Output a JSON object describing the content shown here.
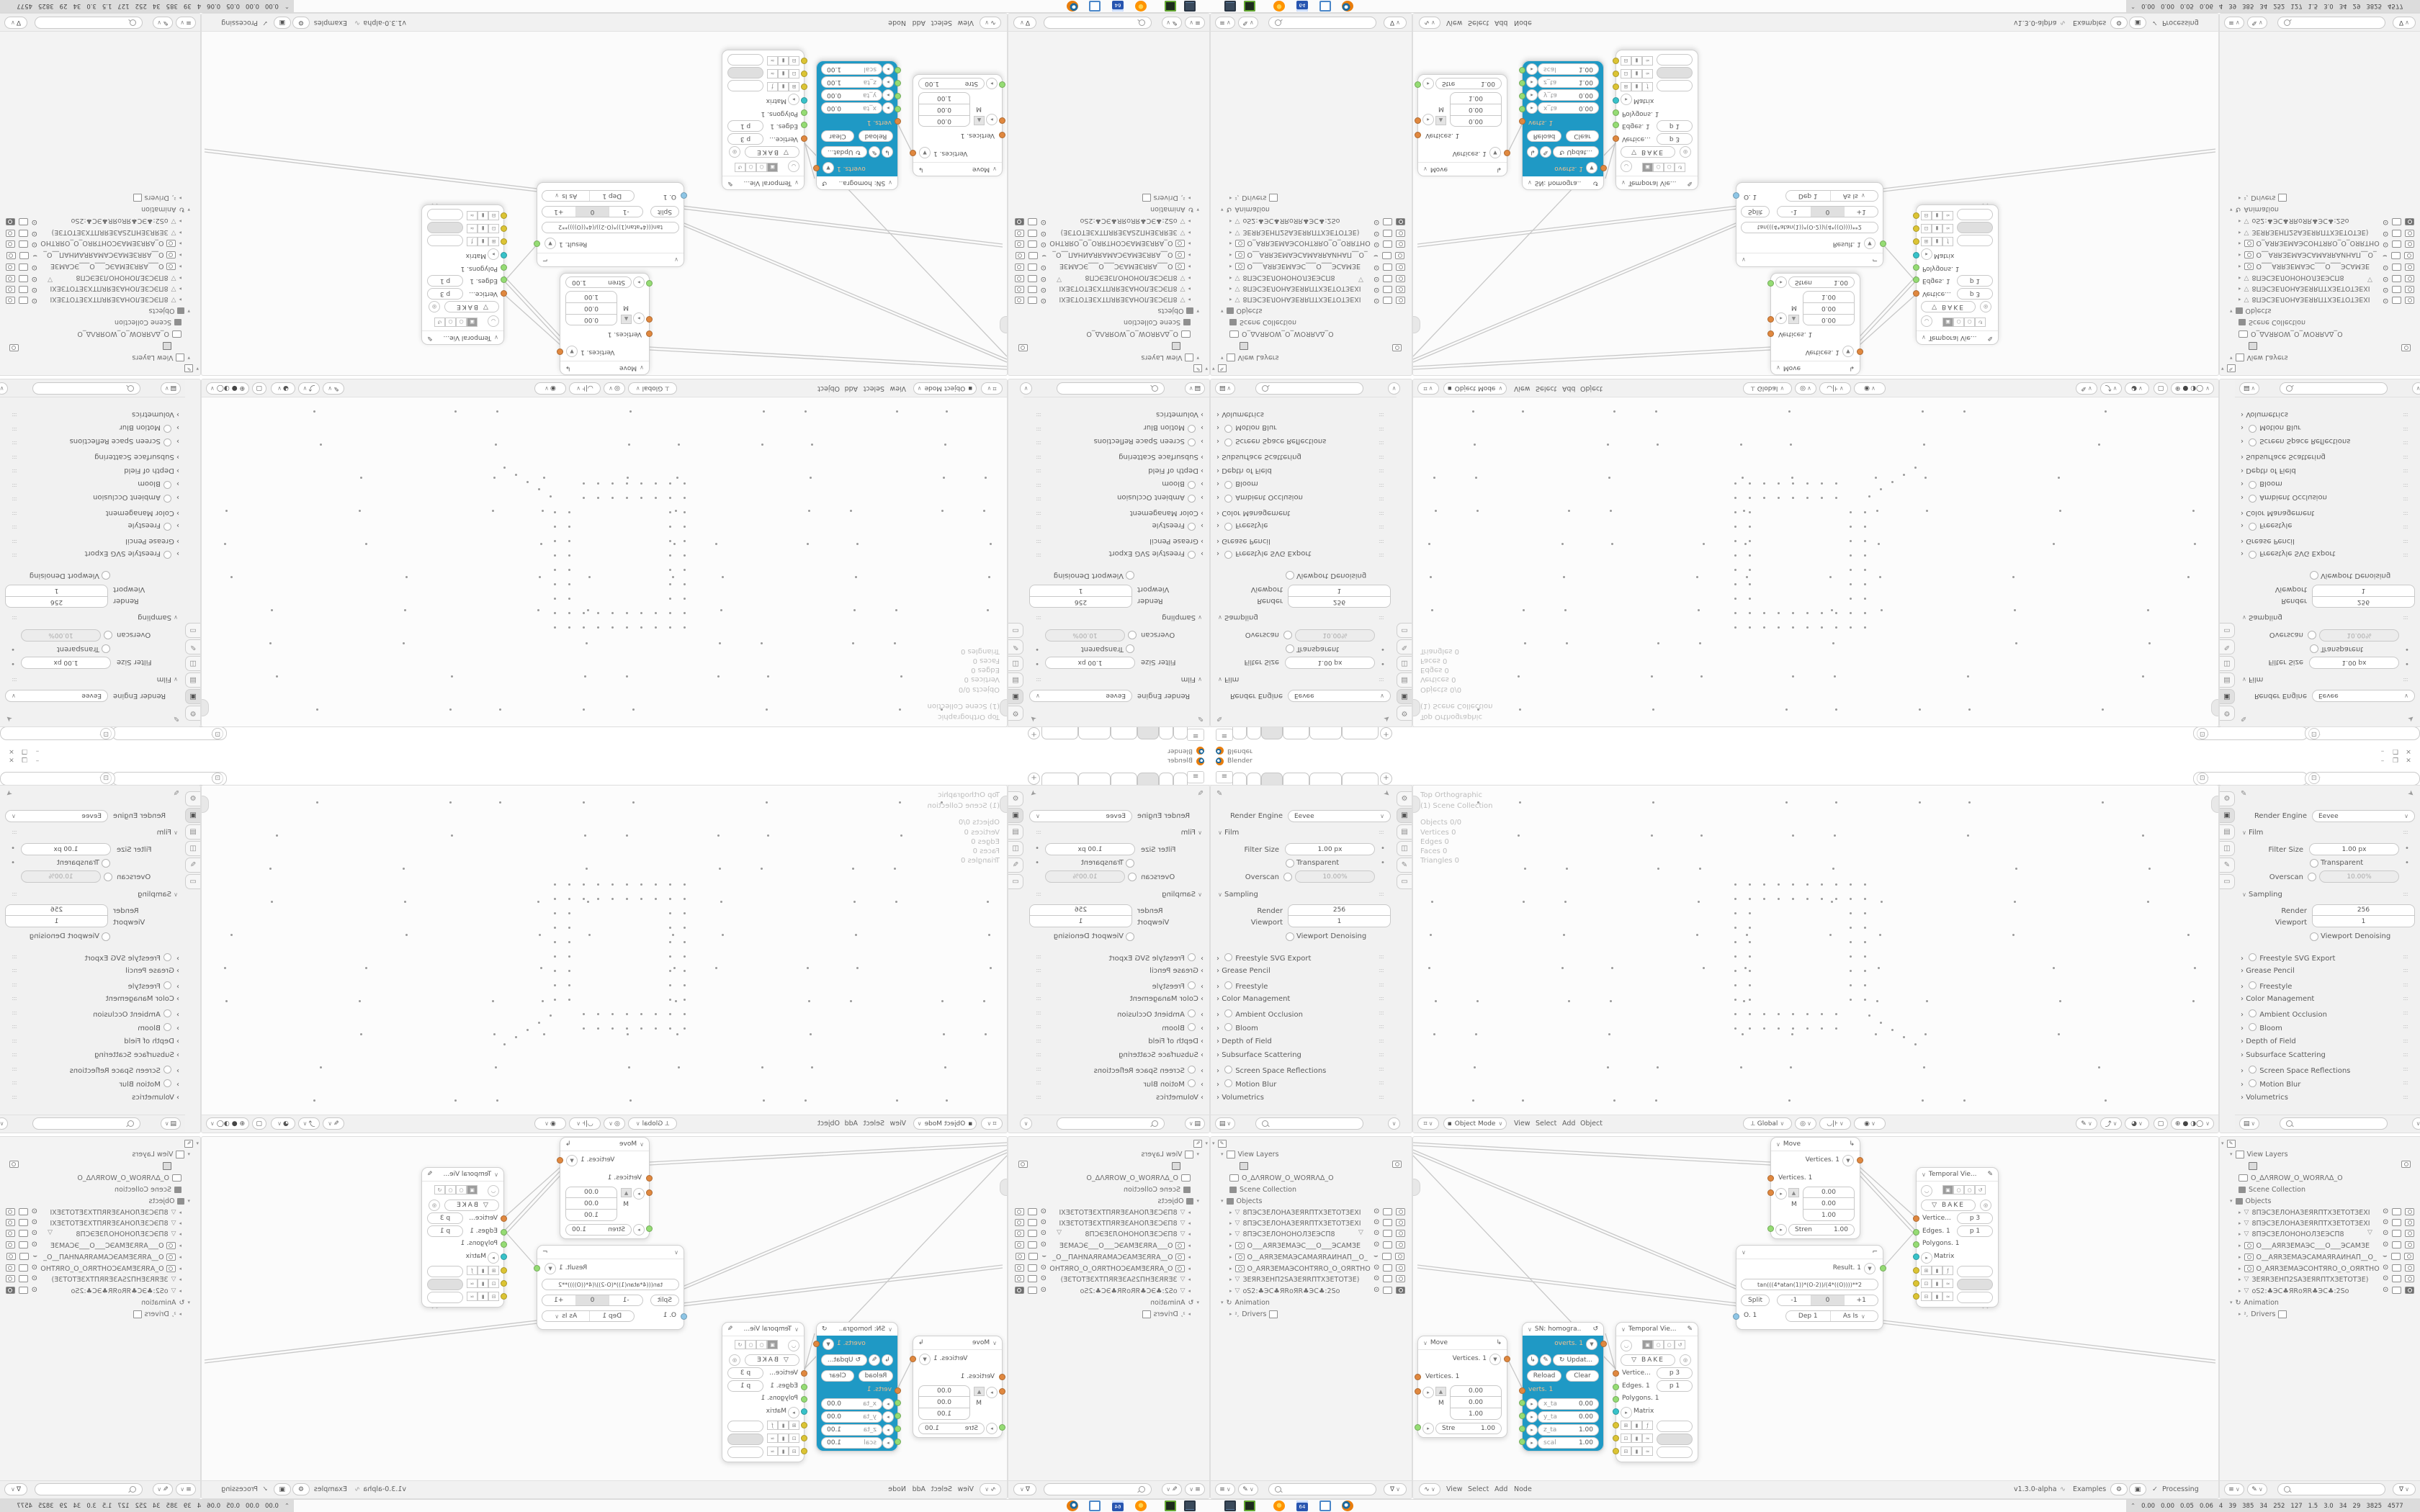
{
  "window": {
    "title": "Blender",
    "minimize": "–",
    "maximize": "❐",
    "close": "✕"
  },
  "topbar": {
    "add_tab_label": "+"
  },
  "props": {
    "render_engine_label": "Render Engine",
    "render_engine_value": "Eevee",
    "film": {
      "title": "Film",
      "filter_size_label": "Filter Size",
      "filter_size_value": "1.00 px",
      "transparent_label": "Transparent",
      "overscan_label": "Overscan",
      "overscan_value": "10.00%"
    },
    "sampling": {
      "title": "Sampling",
      "render_label": "Render",
      "render_value": "256",
      "viewport_label": "Viewport",
      "viewport_value": "1",
      "denoising_label": "Viewport Denoising"
    },
    "collapsed": [
      {
        "label": "Freestyle SVG Export"
      },
      {
        "label": "Grease Pencil"
      },
      {
        "label": "Freestyle"
      },
      {
        "label": "Color Management"
      },
      {
        "label": "Ambient Occlusion"
      },
      {
        "label": "Bloom"
      },
      {
        "label": "Depth of Field"
      },
      {
        "label": "Subsurface Scattering"
      },
      {
        "label": "Screen Space Reflections"
      },
      {
        "label": "Motion Blur"
      },
      {
        "label": "Volumetrics"
      }
    ]
  },
  "viewport": {
    "overlay_lines": [
      "Top Orthographic",
      "(1) Scene Collection",
      "Objects 0/0",
      "Vertices 0",
      "Edges 0",
      "Faces 0",
      "Triangles 0"
    ],
    "mode": "Object Mode",
    "menus": [
      "View",
      "Select",
      "Add",
      "Object"
    ],
    "orientation": "Global"
  },
  "outliner": {
    "view_layers_label": "View Layers",
    "collection_name": "O_ΔΛЯROW_O_WOЯRΛΔ_O",
    "scene_collection_label": "Scene Collection",
    "objects_label": "Objects",
    "objects": [
      {
        "name": "8ПЭСЗЕЛОНАЗЕЯRПТХЗЕТОТЗЕХІ"
      },
      {
        "name": "8ПЭСЗЕЛОНАЗЕЯRПТХЗЕТОТЗЕХІ"
      },
      {
        "name": "8ПЭСЗЕЛОНОНОЛЗЕЭСП8"
      },
      {
        "name": "О___АЯRЗЕМАЭС___О___ЭСАМЗЕ"
      },
      {
        "name": "О__АЯRЗЕМАЭСАМАЯRАИНАП__О_"
      },
      {
        "name": "О_АЯRЗЕМАЭСОНТЯRО_О_ОЯRТНО"
      },
      {
        "name": "ЗЕЯRЗЕНП2SАЗЕЯRПТХЗЕТОТЗЕ)"
      },
      {
        "name": "оS2:♣ЭС♣ЯRоЯR♣ЭС♣:2Sо"
      }
    ],
    "animation_label": "Animation",
    "drivers_label": "Drivers"
  },
  "node_editor": {
    "menus": [
      "View",
      "Select",
      "Add",
      "Node"
    ],
    "version": "v1.3.0-alpha",
    "examples_label": "Examples",
    "processing_label": "Processing",
    "move1": {
      "title": "Move",
      "output": "Vertices. 1",
      "input": "Vertices. 1",
      "m": "M",
      "v1": "0.00",
      "v2": "0.00",
      "v3": "1.00",
      "stre_label": "Stre",
      "stre_value": "1.00"
    },
    "move2": {
      "title": "Move",
      "output": "Vertices. 1",
      "input": "Vertices. 1",
      "m": "M",
      "v1": "0.00",
      "v2": "0.00",
      "v3": "1.00",
      "stre_label": "Stren",
      "stre_value": "1.00"
    },
    "sn": {
      "title": "SN: homogra..",
      "output": "overts. 1",
      "update_label": "Updat...",
      "reload_label": "Reload",
      "clear_label": "Clear",
      "input": "verts. 1",
      "fields": [
        {
          "label": "x_ta",
          "value": "0.00"
        },
        {
          "label": "y_ta",
          "value": "0.00"
        },
        {
          "label": "z_ta",
          "value": "1.00"
        },
        {
          "label": "scal",
          "value": "1.00"
        }
      ]
    },
    "temporal": {
      "title": "Temporal Vie...",
      "bake_label": "BAKE",
      "vertices_label": "Vertice...",
      "vertices_value": "p  3",
      "edges_label": "Edges. 1",
      "edges_value": "p  1",
      "polygons_label": "Polygons. 1",
      "matrix_label": "Matrix"
    },
    "formula": {
      "result": "Result. 1",
      "expression": "tan(((4*atan(1))*(O-2))/(4*((O))))**2",
      "split_label": "Split",
      "minus": "-1",
      "zero": "0",
      "plus": "+1",
      "output": "O. 1",
      "dep": "Dep  1",
      "as_is": "As Is"
    }
  },
  "taskbar": {
    "stats": [
      "0.00",
      "0.00",
      "0.05",
      "0.06",
      "4",
      "39",
      "385",
      "34",
      "252",
      "127",
      "1.5",
      "3.0",
      "34",
      "29",
      "3825",
      "4577"
    ]
  }
}
